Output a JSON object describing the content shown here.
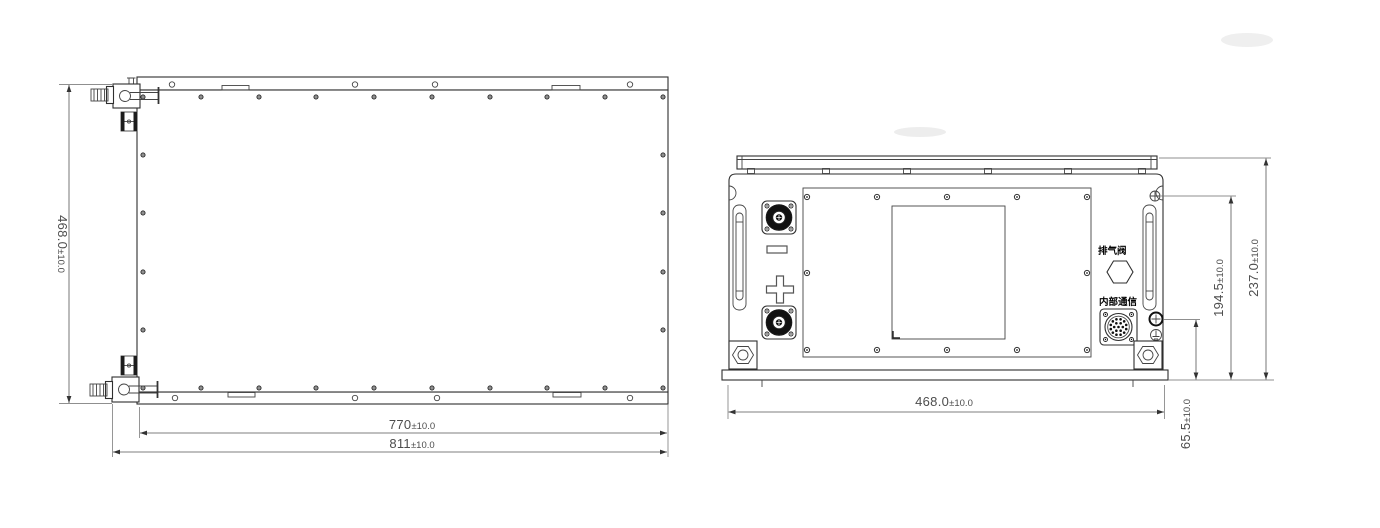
{
  "drawing": {
    "views": {
      "top_view": {
        "dims": {
          "height": {
            "value": "468.0",
            "tolerance": "±10.0"
          },
          "width_body": {
            "value": "770",
            "tolerance": "±10.0"
          },
          "width_overall": {
            "value": "811",
            "tolerance": "±10.0"
          }
        }
      },
      "front_view": {
        "labels": {
          "exhaust_valve": "排气阀",
          "internal_comm": "内部通信"
        },
        "dims": {
          "width": {
            "value": "468.0",
            "tolerance": "±10.0"
          },
          "height_overall": {
            "value": "237.0",
            "tolerance": "±10.0"
          },
          "height_upper_screw": {
            "value": "194.5",
            "tolerance": "±10.0"
          },
          "height_comm_connector": {
            "value": "65.5",
            "tolerance": "±10.0"
          }
        }
      }
    },
    "colors": {
      "line": "#2f2f2f",
      "dim": "#4d4d4d",
      "background": "#ffffff"
    }
  }
}
